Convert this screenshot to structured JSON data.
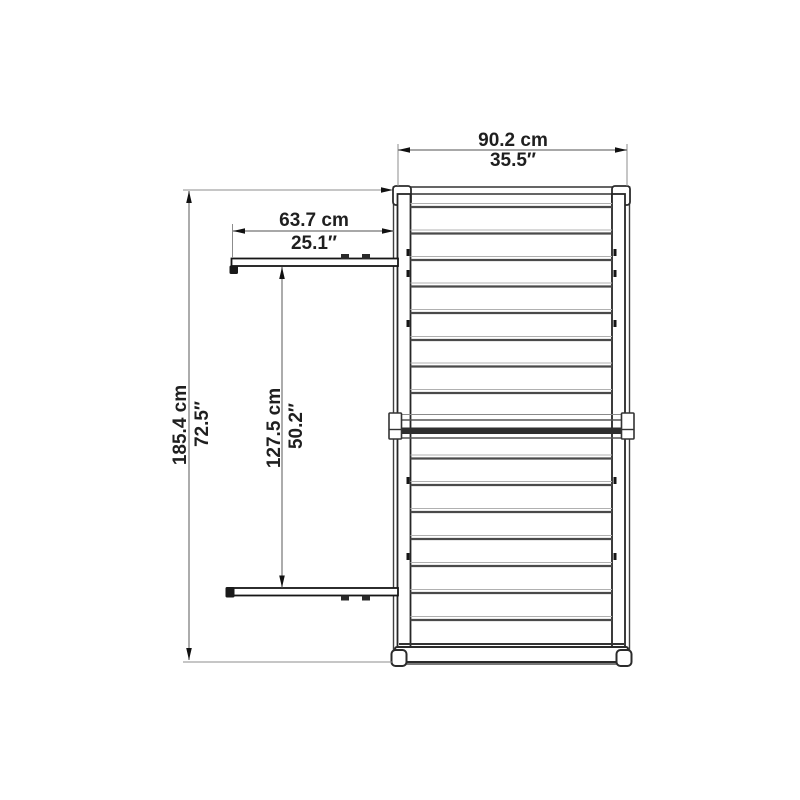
{
  "diagram": {
    "background": "#ffffff",
    "dimension_line_color": "#757575",
    "structure_line_color": "#2b2b2b",
    "text_color": "#1f1f1f",
    "dimensions": {
      "total_width": {
        "cm": "90.2 cm",
        "inch": "35.5″"
      },
      "door_depth": {
        "cm": "63.7 cm",
        "inch": "25.1″"
      },
      "total_height": {
        "cm": "185.4 cm",
        "inch": "72.5″"
      },
      "doors_span": {
        "cm": "127.5 cm",
        "inch": "50.2″"
      }
    }
  }
}
